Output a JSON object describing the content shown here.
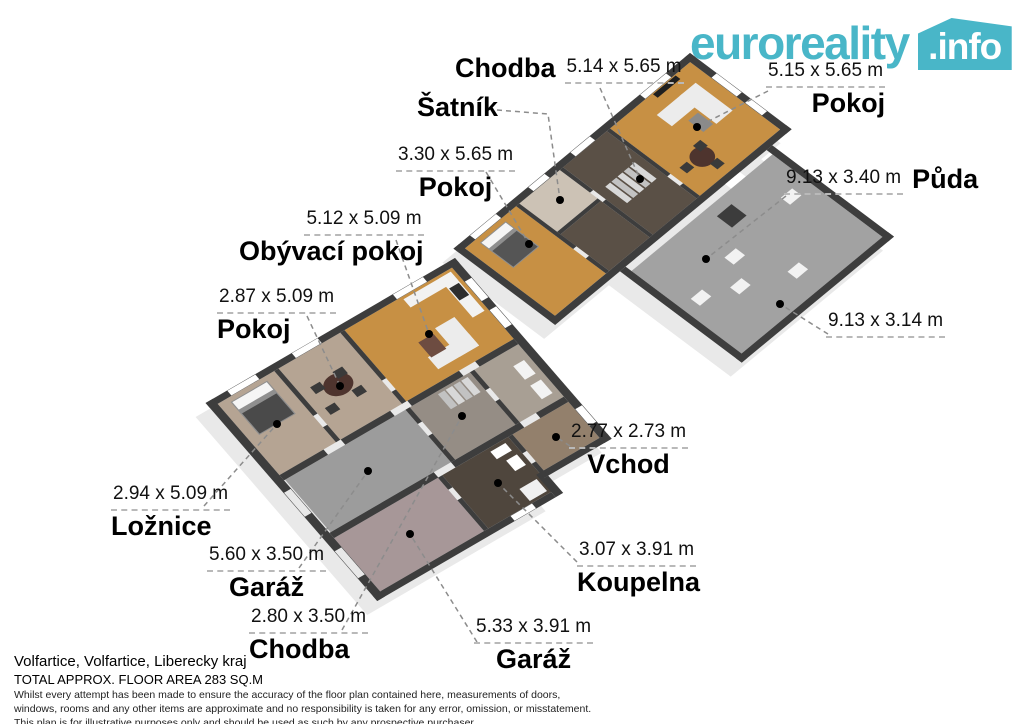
{
  "logo": {
    "brand": "euroreality",
    "badge": ".info",
    "accent_color": "#49b6c8"
  },
  "rooms": [
    {
      "name": "Chodba",
      "dims": "5.14 x 5.65 m"
    },
    {
      "name": "Šatník",
      "dims": ""
    },
    {
      "name": "Pokoj",
      "dims": "3.30 x 5.65 m"
    },
    {
      "name": "Pokoj",
      "dims": "5.15 x 5.65 m"
    },
    {
      "name": "Půda",
      "dims": "9.13 x 3.40 m"
    },
    {
      "name": "",
      "dims": "9.13 x 3.14 m"
    },
    {
      "name": "Obývací pokoj",
      "dims": "5.12 x 5.09 m"
    },
    {
      "name": "Pokoj",
      "dims": "2.87 x 5.09 m"
    },
    {
      "name": "Ložnice",
      "dims": "2.94 x 5.09 m"
    },
    {
      "name": "Garáž",
      "dims": "5.60 x 3.50 m"
    },
    {
      "name": "Chodba",
      "dims": "2.80 x 3.50 m"
    },
    {
      "name": "Garáž",
      "dims": "5.33 x 3.91 m"
    },
    {
      "name": "Koupelna",
      "dims": "3.07 x 3.91 m"
    },
    {
      "name": "Vchod",
      "dims": "2.77 x 2.73 m"
    }
  ],
  "footer": {
    "location": "Volfartice, Volfartice, Liberecky kraj",
    "area": "TOTAL APPROX. FLOOR AREA 283 SQ.M",
    "disclaimer": [
      "Whilst every attempt has been made to ensure the accuracy of the floor plan contained here, measurements of doors,",
      "windows, rooms and any other items are approximate and no responsibility is taken for any error, omission, or misstatement.",
      "This plan is for illustrative purposes only and should be used as such by any prospective purchaser."
    ]
  },
  "colors": {
    "wall": "#3d3d3d",
    "wood_floor": "#c79044",
    "dark_wood_floor": "#5a5046",
    "attic_gray": "#a2a2a2",
    "tan_floor": "#b5a493",
    "garage_gray": "#9c9c9c",
    "garage_mauve": "#a79798",
    "entry_brown": "#93806c",
    "bath_wood": "#4f463d",
    "closet_beige": "#ccc2b5",
    "leader_gray": "#8c8c8c"
  }
}
